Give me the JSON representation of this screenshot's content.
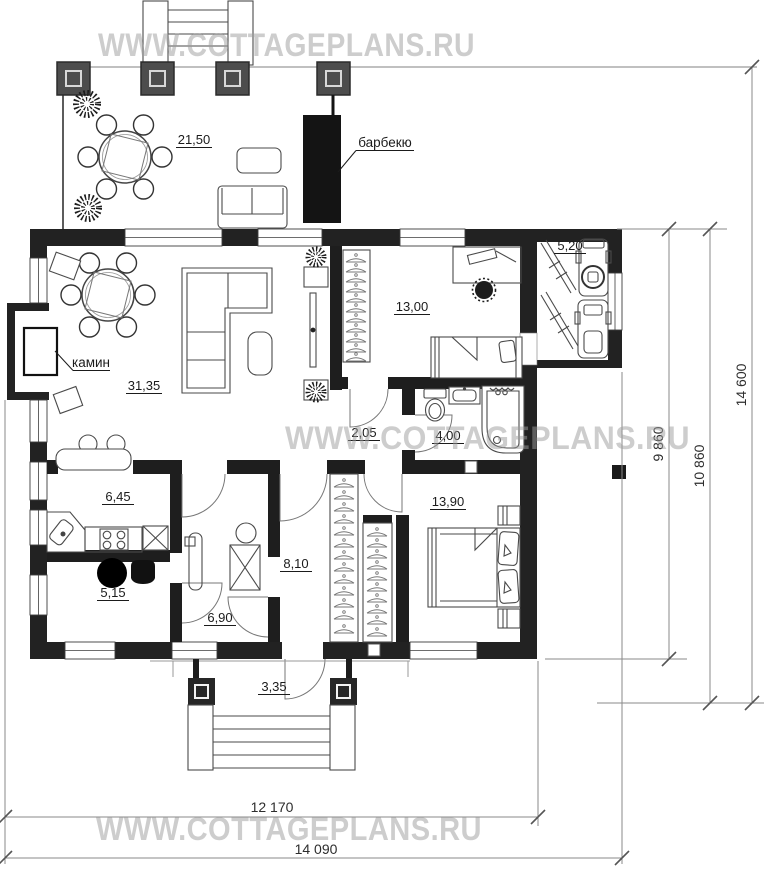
{
  "watermarks": {
    "top": "WWW.COTTAGEPLANS.RU",
    "middle": "WWW.COTTAGEPLANS.RU",
    "bottom": "WWW.COTTAGEPLANS.RU"
  },
  "callouts": {
    "barbecue": "барбекю",
    "fireplace": "камин"
  },
  "rooms": {
    "terrace": {
      "area": "21,50"
    },
    "living": {
      "area": "31,35"
    },
    "bedroom1": {
      "area": "13,00"
    },
    "storage": {
      "area": "5,20"
    },
    "hall_small": {
      "area": "2,05"
    },
    "bathroom": {
      "area": "4,00"
    },
    "kitchen": {
      "area": "6,45"
    },
    "pantry": {
      "area": "5,15"
    },
    "corridor": {
      "area": "8,10"
    },
    "hallway": {
      "area": "6,90"
    },
    "bedroom2": {
      "area": "13,90"
    },
    "porch": {
      "area": "3,35"
    }
  },
  "dimensions": {
    "width_inner": "12 170",
    "width_outer": "14 090",
    "height_inner": "9 860",
    "height_middle": "10 860",
    "height_outer": "14 600"
  },
  "colors": {
    "wall": "#222222",
    "watermark": "#9c9c9c",
    "dimension": "#8a8a8a"
  }
}
